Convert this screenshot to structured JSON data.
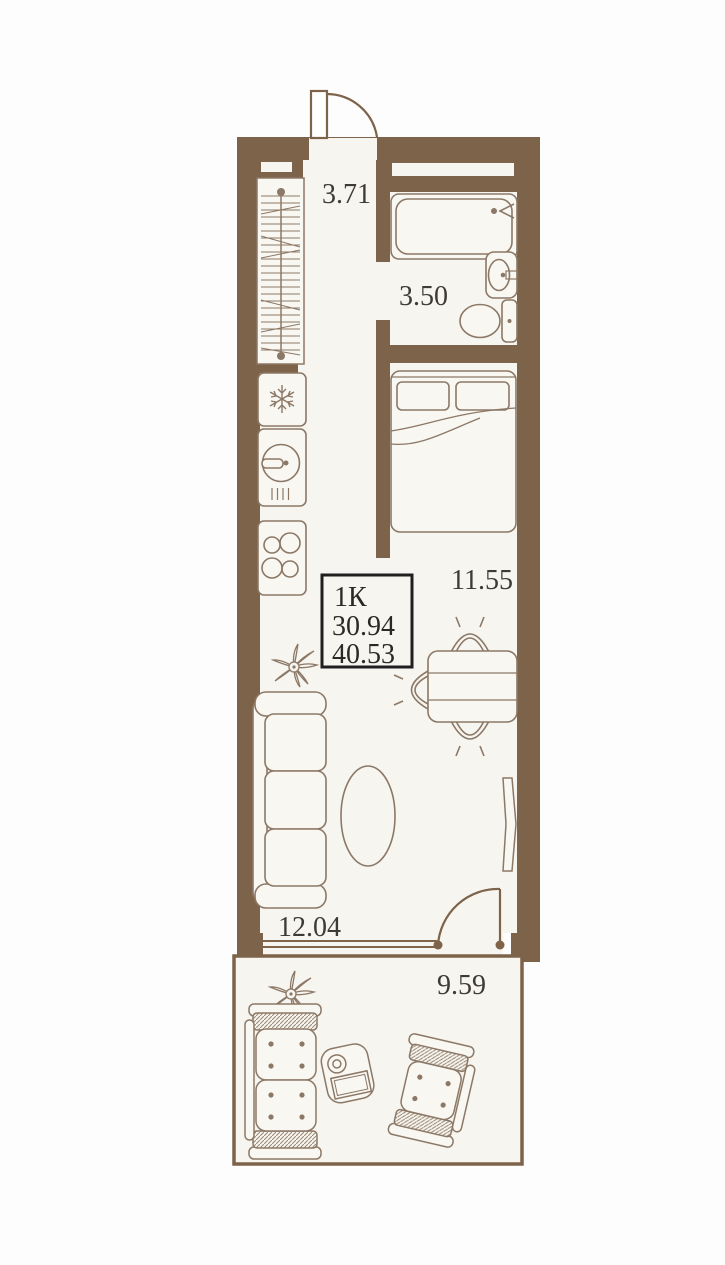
{
  "title": "apartment-floor-plan",
  "unit_info": {
    "type_label": "1К",
    "living_area": "30.94",
    "total_area": "40.53"
  },
  "room_areas": {
    "hallway": "3.71",
    "bathroom": "3.50",
    "bedroom": "11.55",
    "living_room": "12.04",
    "balcony": "9.59"
  },
  "colors": {
    "wall": "#7d6349",
    "floor": "#f7f5f0",
    "furniture_line": "#8c7866",
    "label_text": "#3e3a34",
    "info_box_border": "#1f1f1f",
    "background": "#fdfdfd"
  },
  "symbols": {
    "fridge": "snowflake-icon",
    "plant": "plant-star-icon",
    "stove": "four-burners-icon",
    "doors": "quarter-arc-swing"
  }
}
